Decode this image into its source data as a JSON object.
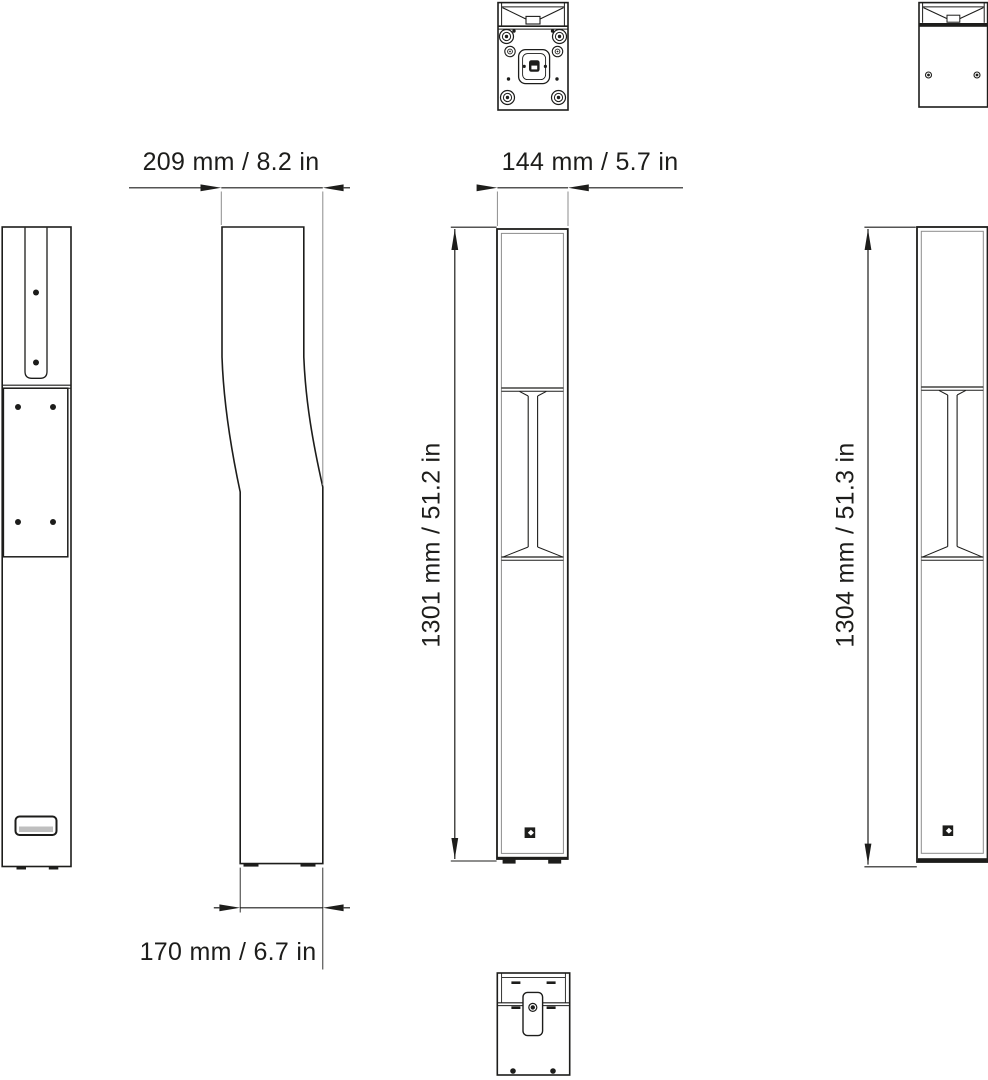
{
  "drawing": {
    "background": "#ffffff",
    "colors": {
      "line": "#1d1d1b",
      "gray_line": "#8c8c8c"
    },
    "dimensions": {
      "depth_top": {
        "label": "209 mm / 8.2 in"
      },
      "width_front": {
        "label": "144 mm / 5.7 in"
      },
      "height_front": {
        "label": "1301 mm / 51.2 in"
      },
      "height_rear": {
        "label": "1304 mm / 51.3 in"
      },
      "depth_bottom": {
        "label": "170 mm / 6.7 in"
      }
    }
  }
}
